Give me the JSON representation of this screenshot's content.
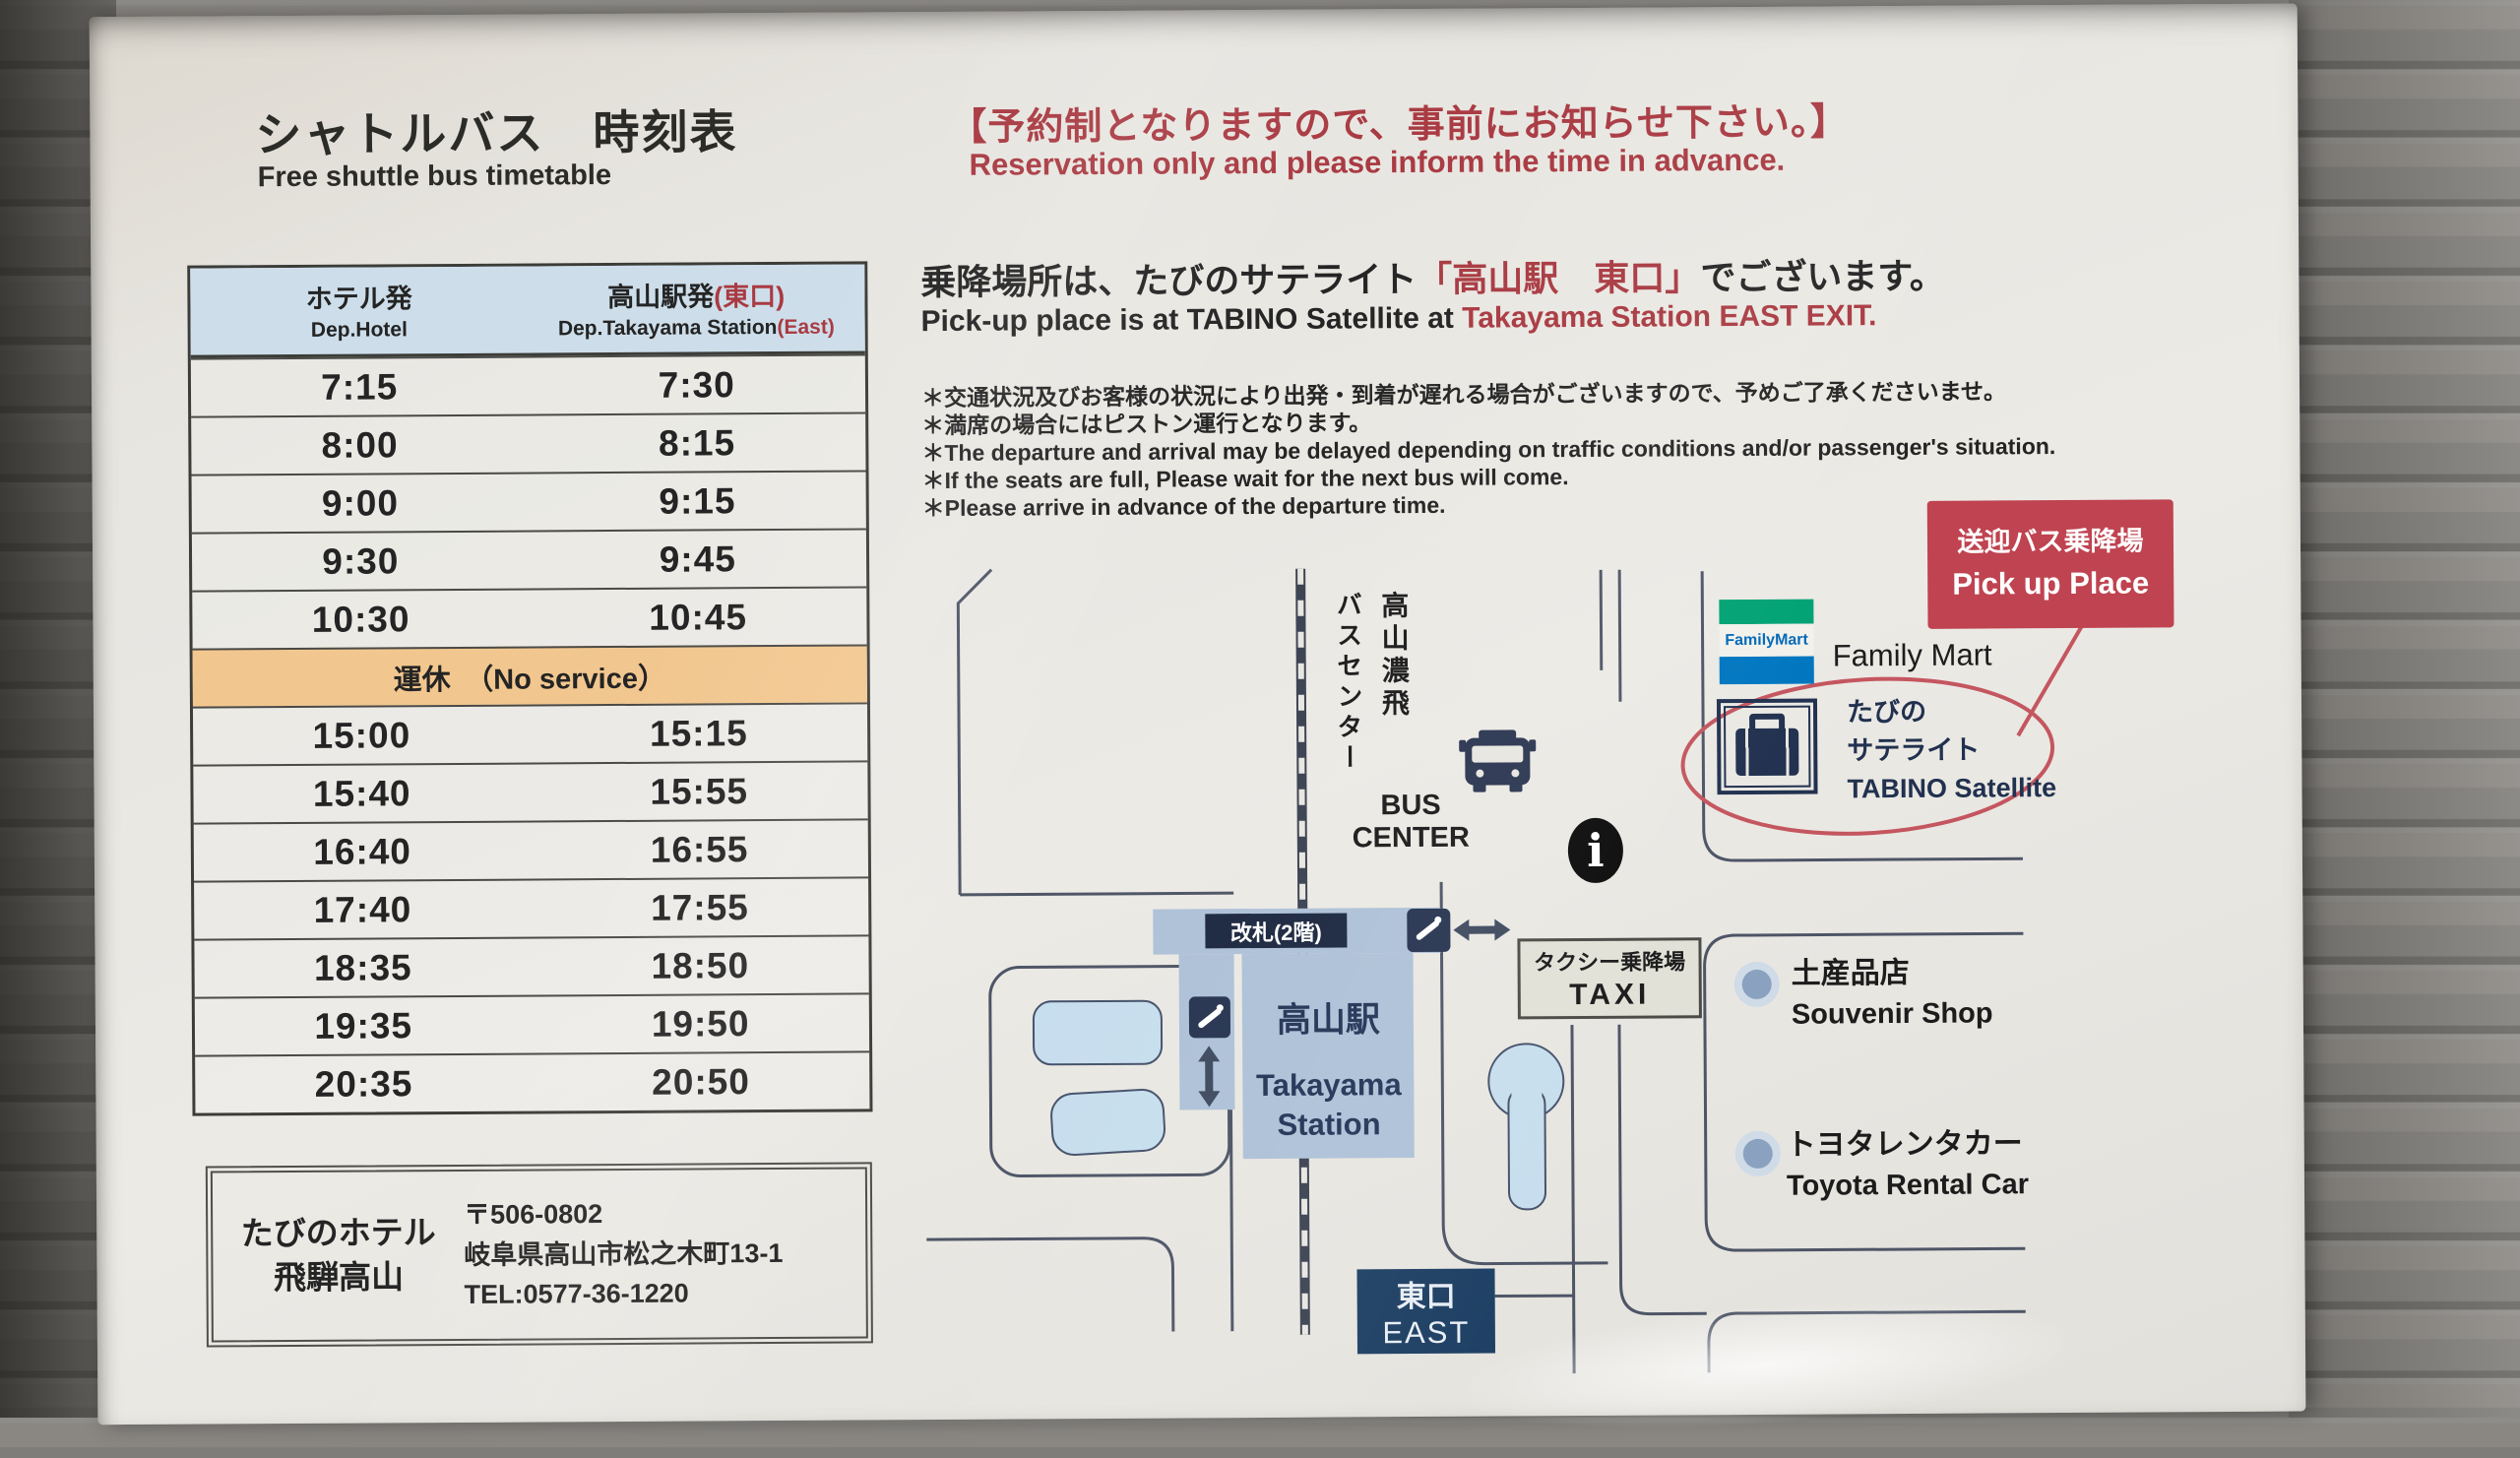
{
  "header": {
    "title_jp": "シャトルバス　時刻表",
    "title_en": "Free shuttle bus timetable",
    "reservation_jp": "【予約制となりますので、事前にお知らせ下さい。】",
    "reservation_en": "Reservation only and please inform the time  in advance."
  },
  "pickup": {
    "jp_black_1": "乗降場所は、たびのサテライト",
    "jp_red": "「高山駅　東口」",
    "jp_black_2": "でございます。",
    "en_black": "Pick-up place is at  TABINO Satellite at ",
    "en_red": "Takayama Station EAST EXIT."
  },
  "notes": [
    "＊交通状況及びお客様の状況により出発・到着が遅れる場合がございますので、予めご了承くださいませ。",
    "＊満席の場合にはピストン運行となります。",
    "＊The departure and arrival may be delayed depending on traffic conditions and/or passenger's situation.",
    "＊If the seats are full, Please wait for the next bus will come.",
    "＊Please arrive in advance of the departure time."
  ],
  "timetable": {
    "col1_jp": "ホテル発",
    "col1_en": "Dep.Hotel",
    "col2_jp": "高山駅発",
    "col2_jp_red": "(東口)",
    "col2_en": "Dep.Takayama Station",
    "col2_en_red": "(East)",
    "no_service": "運休　（No service）",
    "rows": [
      {
        "dep": "7:15",
        "arr": "7:30"
      },
      {
        "dep": "8:00",
        "arr": "8:15"
      },
      {
        "dep": "9:00",
        "arr": "9:15"
      },
      {
        "dep": "9:30",
        "arr": "9:45"
      },
      {
        "dep": "10:30",
        "arr": "10:45"
      },
      {
        "dep": "15:00",
        "arr": "15:15"
      },
      {
        "dep": "15:40",
        "arr": "15:55"
      },
      {
        "dep": "16:40",
        "arr": "16:55"
      },
      {
        "dep": "17:40",
        "arr": "17:55"
      },
      {
        "dep": "18:35",
        "arr": "18:50"
      },
      {
        "dep": "19:35",
        "arr": "19:50"
      },
      {
        "dep": "20:35",
        "arr": "20:50"
      }
    ]
  },
  "hotel": {
    "name_line1": "たびのホテル",
    "name_line2": "飛騨高山",
    "postal": "〒506-0802",
    "address": "岐阜県高山市松之木町13-1",
    "tel": "TEL:0577-36-1220"
  },
  "map": {
    "pickup_box_jp": "送迎バス乗降場",
    "pickup_box_en": "Pick up Place",
    "familymart_logo": "FamilyMart",
    "familymart_label": "Family Mart",
    "tabino_jp1": "たびの",
    "tabino_jp2": "サテライト",
    "tabino_en": "TABINO Satellite",
    "busline_col_right": "高山濃飛",
    "busline_col_left": "バスセンター",
    "bus_center_en": "BUS\nCENTER",
    "gate_label": "改札(2階)",
    "taxi_jp": "タクシー乗降場",
    "taxi_en": "TAXI",
    "station_jp": "高山駅",
    "station_en1": "Takayama",
    "station_en2": "Station",
    "east_jp": "東口",
    "east_en": "EAST",
    "souvenir_jp": "土産品店",
    "souvenir_en": "Souvenir Shop",
    "toyota_jp": "トヨタレンタカー",
    "toyota_en": "Toyota Rental Car",
    "info_letter": "i"
  },
  "colors": {
    "accent_red": "#a93a42",
    "pickup_box_red": "#bf4350",
    "table_header_blue": "#cddeea",
    "no_service_tan": "#f2c78f",
    "station_fill": "#aec1d7",
    "navy": "#21314f",
    "east_box_navy": "#1d3f63",
    "road": "#4d5566",
    "pond_blue": "#c7deee",
    "familymart_green": "#00a273",
    "familymart_blue": "#0076c0"
  }
}
